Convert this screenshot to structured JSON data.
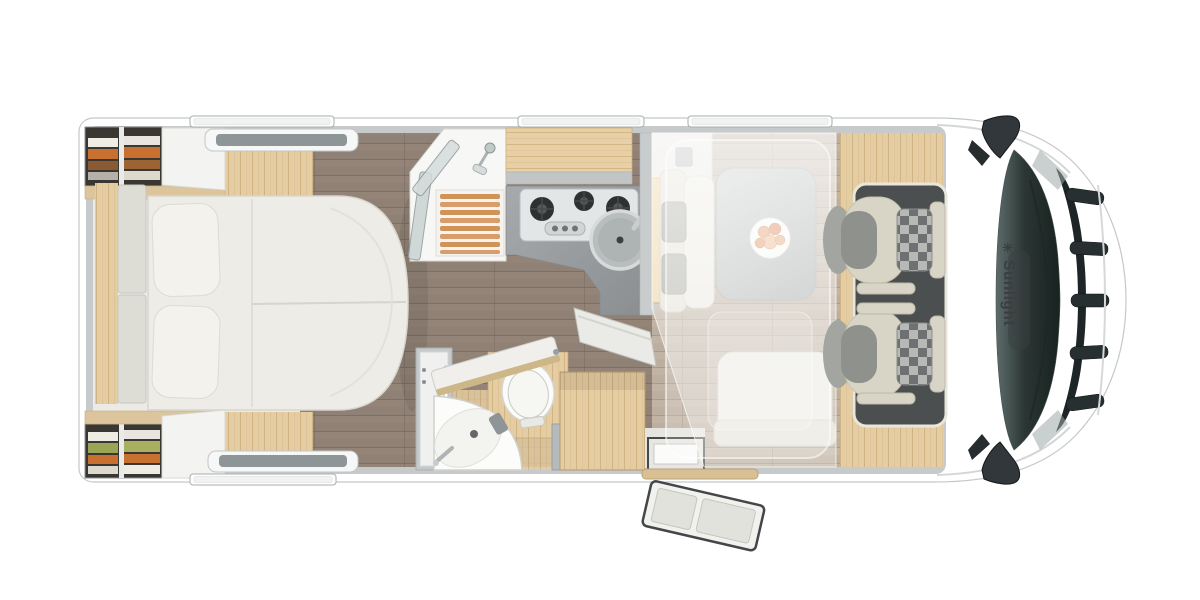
{
  "image": {
    "type": "motorhome-floorplan-top-view",
    "width_px": 1200,
    "height_px": 600
  },
  "brand": {
    "name": "Sunlight",
    "logo_glyph": "✳",
    "text_orientation": "rotated-90-on-cab-hood"
  },
  "floorplan": {
    "zones": [
      "rear-bedroom-island-bed",
      "shower",
      "kitchen",
      "bathroom",
      "wardrobe",
      "dinette-with-drop-down-bed",
      "driver-cab"
    ],
    "counts": {
      "roof_windows_top": 3,
      "roof_windows_bottom": 1,
      "skylights": 2,
      "stove_burners": 3,
      "cab_seats": 2,
      "pillows": 2,
      "wardrobes_rear": 2
    },
    "features": [
      "island-bed",
      "corner-washbasin",
      "toilet",
      "round-kitchen-sink",
      "dinette-table-with-plate",
      "open-entry-door-with-step",
      "drop-down-bed-overlay",
      "side-mirrors"
    ]
  },
  "colors": {
    "page_bg": "#ffffff",
    "body_white": "#ffffff",
    "wall_gray": "#c7cacb",
    "pale_floor": "#eceae4",
    "floor_brown": "#8f8175",
    "floor_dinette": "#bdaf9f",
    "wood_light": "#e5cda3",
    "wood_shelf": "#dcc49c",
    "cream": "#edece6",
    "seat_cream": "#d9d5c6",
    "seat_gray": "#8f918d",
    "counter_gray": "#989c9e",
    "cab_floor_dark": "#4b4f50",
    "glass_dark": "#2b3634",
    "brand_text": "#3b3e40",
    "accent_orange": "#c87030",
    "accent_green": "#9aa556",
    "food_orange": "#e89a63",
    "check_dark": "#6e7072",
    "check_light": "#b7b9b7"
  }
}
